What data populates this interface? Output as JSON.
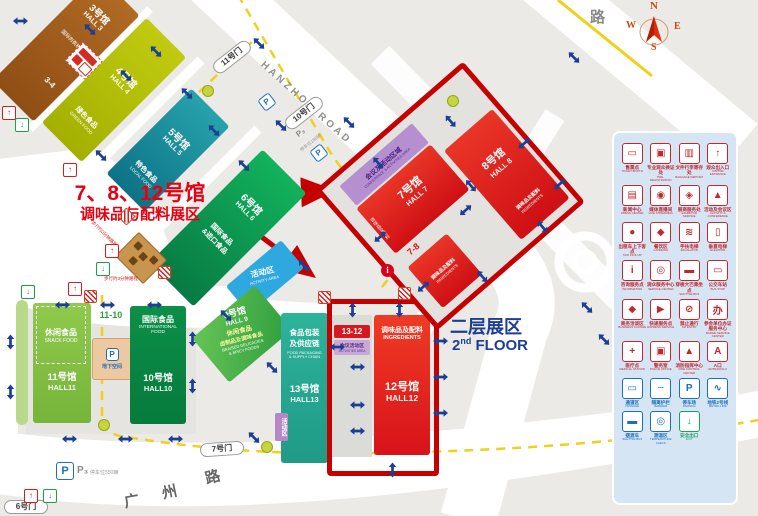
{
  "title": {
    "line1": "7、8、12号馆",
    "line2": "调味品与配料展区"
  },
  "floor_note": {
    "zh": "二层展区",
    "num": "2",
    "sup": "nd",
    "rest": " FLOOR"
  },
  "compass": {
    "n": "N",
    "e": "E",
    "s": "S",
    "w": "W"
  },
  "roads": {
    "hanzhou": "HANZHOU ROAD",
    "lu": "路",
    "gz1": "广",
    "gz2": "州",
    "gz3": "路"
  },
  "gates": {
    "g6": "6号门",
    "g7": "7号门",
    "g10": "10号门",
    "g11": "11号门"
  },
  "parking": {
    "p": "P",
    "p3": "P₃",
    "bottom_note": "停车位550辆",
    "mid_note": "停车位180辆"
  },
  "halls": {
    "h3": {
      "name": "3号馆",
      "en": "HALL 3",
      "sub": "国际肉类机械"
    },
    "h4": {
      "name": "4号馆",
      "en": "HALL 4",
      "sub": "绿色食品",
      "sub_en": "GREEN FOOD"
    },
    "h5": {
      "name": "5号馆",
      "en": "HALL 5",
      "sub": "特色食品",
      "sub_en": "LOCAL FOOD"
    },
    "h6": {
      "name": "6号馆",
      "en": "HALL 6",
      "sub": "国际食品",
      "sub2": "&进口食品"
    },
    "h7": {
      "name": "7号馆",
      "en": "HALL 7",
      "sub": "调味品及配料",
      "sub_en": "INGREDIENTS"
    },
    "h8": {
      "name": "8号馆",
      "en": "HALL 8",
      "sub": "调味品及配料",
      "sub_en": "INGREDIENTS"
    },
    "h9": {
      "name": "9号馆",
      "en": "HALL 9",
      "sub": "休闲食品",
      "sub2": "卤制品及调味食品",
      "sub_en": "BRAISED DELICACIES",
      "sub_en2": "& SPICY FOODS"
    },
    "h10": {
      "name": "10号馆",
      "en": "HALL10",
      "sub": "国际食品",
      "sub_en": "INTERNATIONAL",
      "sub_en2": "FOOD"
    },
    "h11": {
      "name": "11号馆",
      "en": "HALL11",
      "sub": "休闲食品",
      "sub_en": "SNACK FOOD"
    },
    "h12": {
      "name": "12号馆",
      "en": "HALL12",
      "sub": "调味品及配料",
      "sub_en": "INGREDIENTS"
    },
    "h13": {
      "name": "13号馆",
      "en": "HALL13",
      "sub": "食品包装",
      "sub2": "及供应链",
      "sub_en": "FOOD PACKAGING",
      "sub_en2": "& SUPPLY CHAIN"
    }
  },
  "links": {
    "l34": "3-4",
    "l78": "7-8",
    "l1110": "11-10",
    "l1312": "13-12"
  },
  "areas": {
    "conference": {
      "zh": "会议及活动区域",
      "en": "CONFERENCE & ACTIVITIES AREA"
    },
    "activity_blue": {
      "zh": "活动区",
      "en": "ACTIVITY AREA"
    },
    "activity_purple": {
      "zh": "活动区"
    },
    "activity_1312": {
      "zh": "会议活动区",
      "en": "ACTIVITIES AREA"
    },
    "underground": {
      "zh": "地下空间"
    }
  },
  "notes": {
    "walk1": "步行约3分钟路程",
    "walk2": "步行约3分钟路程"
  },
  "colors": {
    "title_red": "#e60012",
    "frame_red": "#c40000",
    "navy": "#1c3f93",
    "legend_red": "#c1272d",
    "legend_blue": "#1a6fbe",
    "legend_green": "#17a457"
  },
  "legend": {
    "items": [
      {
        "zh": "售票点",
        "en": "TICKET BOOTH",
        "g": "▭",
        "c": "#c1272d"
      },
      {
        "zh": "专业观众换证处",
        "en": "PRE-REGISTRATION",
        "g": "▣",
        "c": "#c1272d"
      },
      {
        "zh": "文件行李寄存处",
        "en": "BAGGAGE DEPOSIT",
        "g": "▥",
        "c": "#c1272d"
      },
      {
        "zh": "观众出入口",
        "en": "VISITOR ENTRANCE",
        "g": "↑",
        "c": "#c1272d"
      },
      {
        "zh": "新闻中心",
        "en": "PRESS CENTER",
        "g": "▤",
        "c": "#c1272d"
      },
      {
        "zh": "媒体直播间",
        "en": "LIVE STREAMING",
        "g": "◉",
        "c": "#c1272d"
      },
      {
        "zh": "展商服务处",
        "en": "EXHIBITOR SERVICE",
        "g": "◈",
        "c": "#c1272d"
      },
      {
        "zh": "活动及会议区",
        "en": "ACTIVITY & CONFERENCE",
        "g": "▲",
        "c": "#c1272d"
      },
      {
        "zh": "出租车上下客点",
        "en": "TAXI PICK-UP",
        "g": "●",
        "c": "#c1272d"
      },
      {
        "zh": "餐饮区",
        "en": "CATERING",
        "g": "◆",
        "c": "#c1272d"
      },
      {
        "zh": "手扶电梯",
        "en": "ESCALATOR",
        "g": "≋",
        "c": "#c1272d"
      },
      {
        "zh": "垂直电梯",
        "en": "ELEVATOR",
        "g": "▯",
        "c": "#c1272d"
      },
      {
        "zh": "咨询服务点",
        "en": "INFORMATION",
        "g": "i",
        "c": "#c1272d"
      },
      {
        "zh": "观众服务中心",
        "en": "SERVICE CENTER",
        "g": "◎",
        "c": "#c1272d"
      },
      {
        "zh": "穿梭大巴乘坐点",
        "en": "SHUTTLE BUS",
        "g": "▬",
        "c": "#c1272d"
      },
      {
        "zh": "公交车站",
        "en": "BUS STOP",
        "g": "▭",
        "c": "#c1272d"
      },
      {
        "zh": "商务洽谈区",
        "en": "BUSINESS LOUNGE",
        "g": "◆",
        "c": "#c1272d"
      },
      {
        "zh": "快递服务点",
        "en": "EXPRESS SERVICE",
        "g": "▶",
        "c": "#c1272d"
      },
      {
        "zh": "禁止通行",
        "en": "NO ENTRY",
        "g": "⊘",
        "c": "#c1272d"
      },
      {
        "zh": "参会单位办证服务中心",
        "en": "BADGE SERVICE CENTER",
        "g": "办",
        "c": "#c1272d"
      },
      {
        "zh": "医疗点",
        "en": "MEDICAL STATION",
        "g": "+",
        "c": "#c1272d"
      },
      {
        "zh": "警务室",
        "en": "POLICE OFFICE",
        "g": "▣",
        "c": "#c1272d"
      },
      {
        "zh": "消防指挥中心",
        "en": "FIRE CONTROL CENTER",
        "g": "▲",
        "c": "#c1272d"
      },
      {
        "zh": "A口",
        "en": "ENTRANCE A",
        "g": "A",
        "c": "#c1272d"
      },
      {
        "zh": "通道区",
        "en": "PASSAGE",
        "g": "▭",
        "c": "#1a6fbe"
      },
      {
        "zh": "隔离护栏",
        "en": "BARRIER",
        "g": "┄",
        "c": "#1a6fbe"
      },
      {
        "zh": "停车场",
        "en": "PARKING",
        "g": "P",
        "c": "#1a6fbe"
      },
      {
        "zh": "地铁2号线",
        "en": "METRO LINE",
        "g": "∿",
        "c": "#1a6fbe"
      },
      {
        "zh": "摆渡车",
        "en": "SHUTTLE BUS",
        "g": "▬",
        "c": "#1a6fbe"
      },
      {
        "zh": "测温区",
        "en": "TEMPERATURE CHECK",
        "g": "◎",
        "c": "#1a6fbe"
      },
      {
        "zh": "安全出口",
        "en": "EXIT",
        "g": "↓",
        "c": "#17a457"
      }
    ]
  }
}
